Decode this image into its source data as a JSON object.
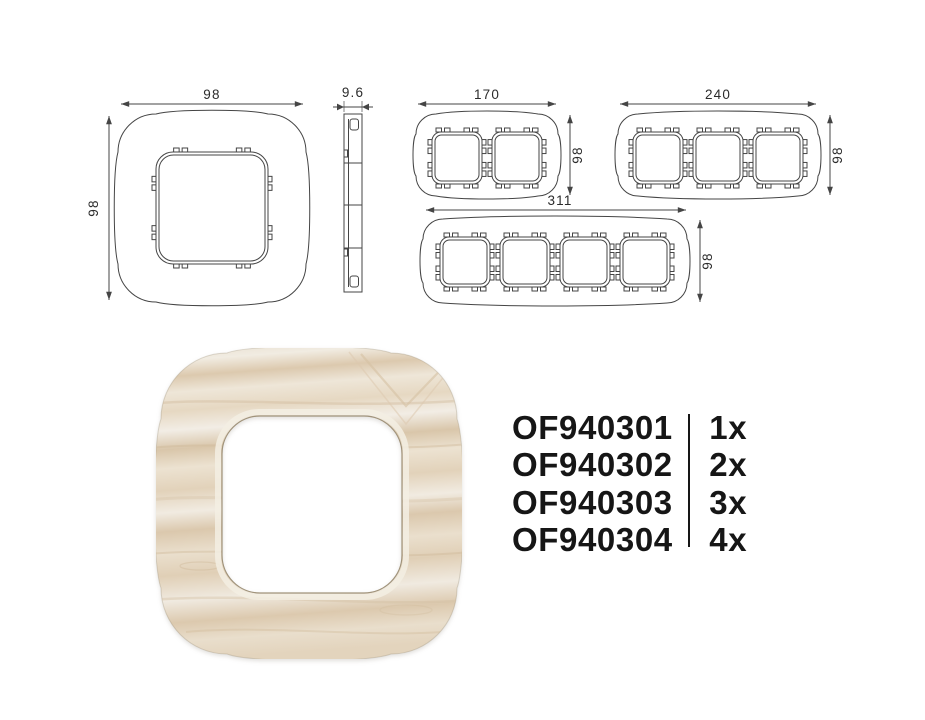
{
  "drawings": {
    "front_1gang": {
      "width": "98",
      "height": "98"
    },
    "side_profile": {
      "depth": "9.6"
    },
    "front_2gang": {
      "width": "170",
      "height": "98"
    },
    "front_3gang": {
      "width": "240",
      "height": "98"
    },
    "front_4gang": {
      "width": "311",
      "height": "98"
    }
  },
  "products": [
    {
      "code": "OF940301",
      "count": "1x"
    },
    {
      "code": "OF940302",
      "count": "2x"
    },
    {
      "code": "OF940303",
      "count": "3x"
    },
    {
      "code": "OF940304",
      "count": "4x"
    }
  ],
  "colors": {
    "line": "#454545",
    "text": "#2b2b2b",
    "code_text": "#161616",
    "wood_base": "#e9dfcf",
    "wood_streak": "#d8c5a9",
    "opening_outline": "#a0937b"
  }
}
